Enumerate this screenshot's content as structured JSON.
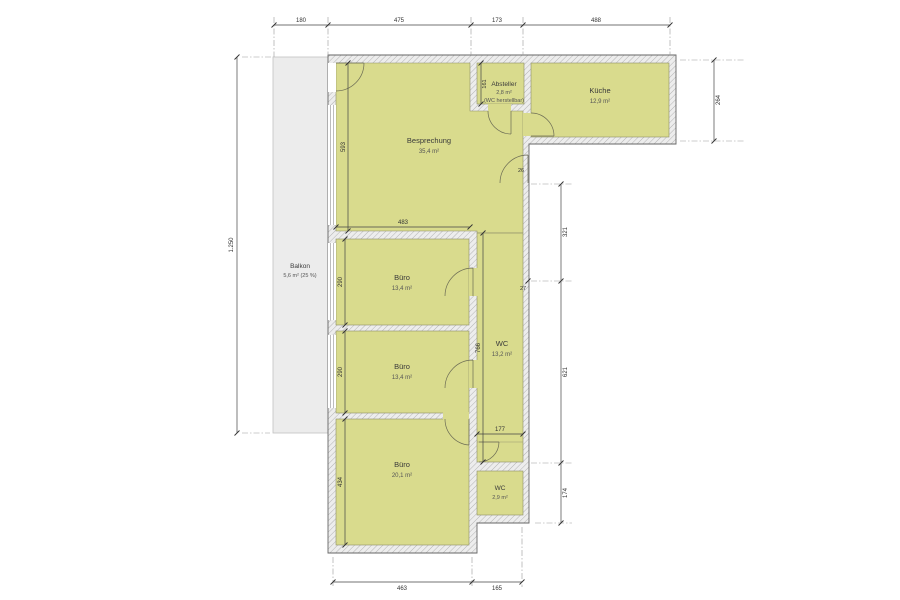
{
  "plan": {
    "rooms": {
      "besprechung": {
        "name": "Besprechung",
        "area": "35,4 m²"
      },
      "absteller": {
        "name": "Absteller",
        "area": "2,8 m²",
        "note": "(WC herstellbar)"
      },
      "kueche": {
        "name": "Küche",
        "area": "12,9 m²"
      },
      "balkon": {
        "name": "Balkon",
        "area": "5,6 m² (25 %)"
      },
      "buero_top": {
        "name": "Büro",
        "area": "13,4 m²"
      },
      "buero_mid": {
        "name": "Büro",
        "area": "13,4 m²"
      },
      "buero_bottom": {
        "name": "Büro",
        "area": "20,1 m²"
      },
      "wc_long": {
        "name": "WC",
        "area": "13,2 m²"
      },
      "wc_small": {
        "name": "WC",
        "area": "2,9 m²"
      }
    },
    "dims": {
      "top": [
        "180",
        "475",
        "173",
        "488"
      ],
      "bottom": [
        "463",
        "165"
      ],
      "left_total": "1.250",
      "kueche_depth": "264",
      "right_upper": "321",
      "right_lower": "621",
      "wc_small_depth": "174",
      "step": "27",
      "door": "26",
      "besprechung_h": "593",
      "besprechung_w": "483",
      "absteller_h": "161",
      "buero_top_h": "290",
      "buero_mid_h": "290",
      "buero_bottom_h": "434",
      "wc_long_h": "766",
      "wc_long_w": "177"
    },
    "colors": {
      "room_fill": "#d9db8d",
      "balcony_fill": "#ececec",
      "wall_hatch_bg": "#ededed"
    }
  }
}
